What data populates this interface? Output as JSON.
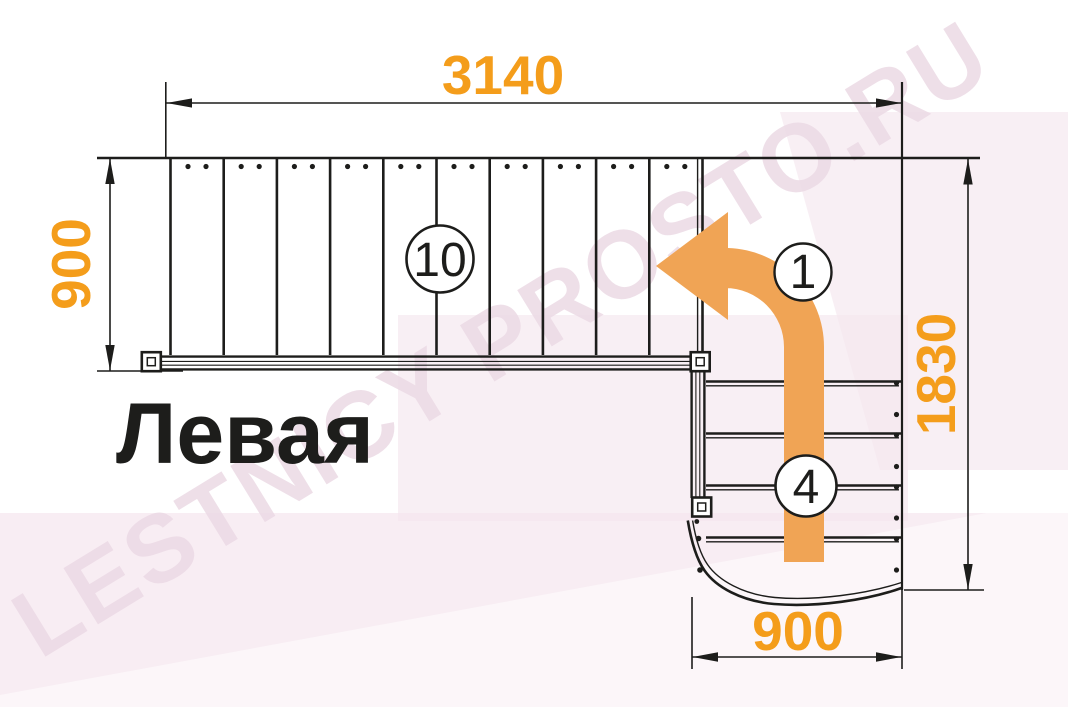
{
  "diagram": {
    "title": "Левая",
    "watermark": "LESTNICY PROSTO.RU",
    "dimensions": {
      "top_width": "3140",
      "left_depth": "900",
      "right_height": "1830",
      "bottom_width": "900"
    },
    "step_labels": {
      "upper_flight": "10",
      "turn": "1",
      "lower_flight": "4"
    },
    "colors": {
      "dimension_text": "#F49D1B",
      "arrow_fill": "#F0A455",
      "line_color": "#1D1D1B",
      "watermark_pink": "#ECDAE5",
      "background_pink": "#F5E6EE"
    }
  }
}
